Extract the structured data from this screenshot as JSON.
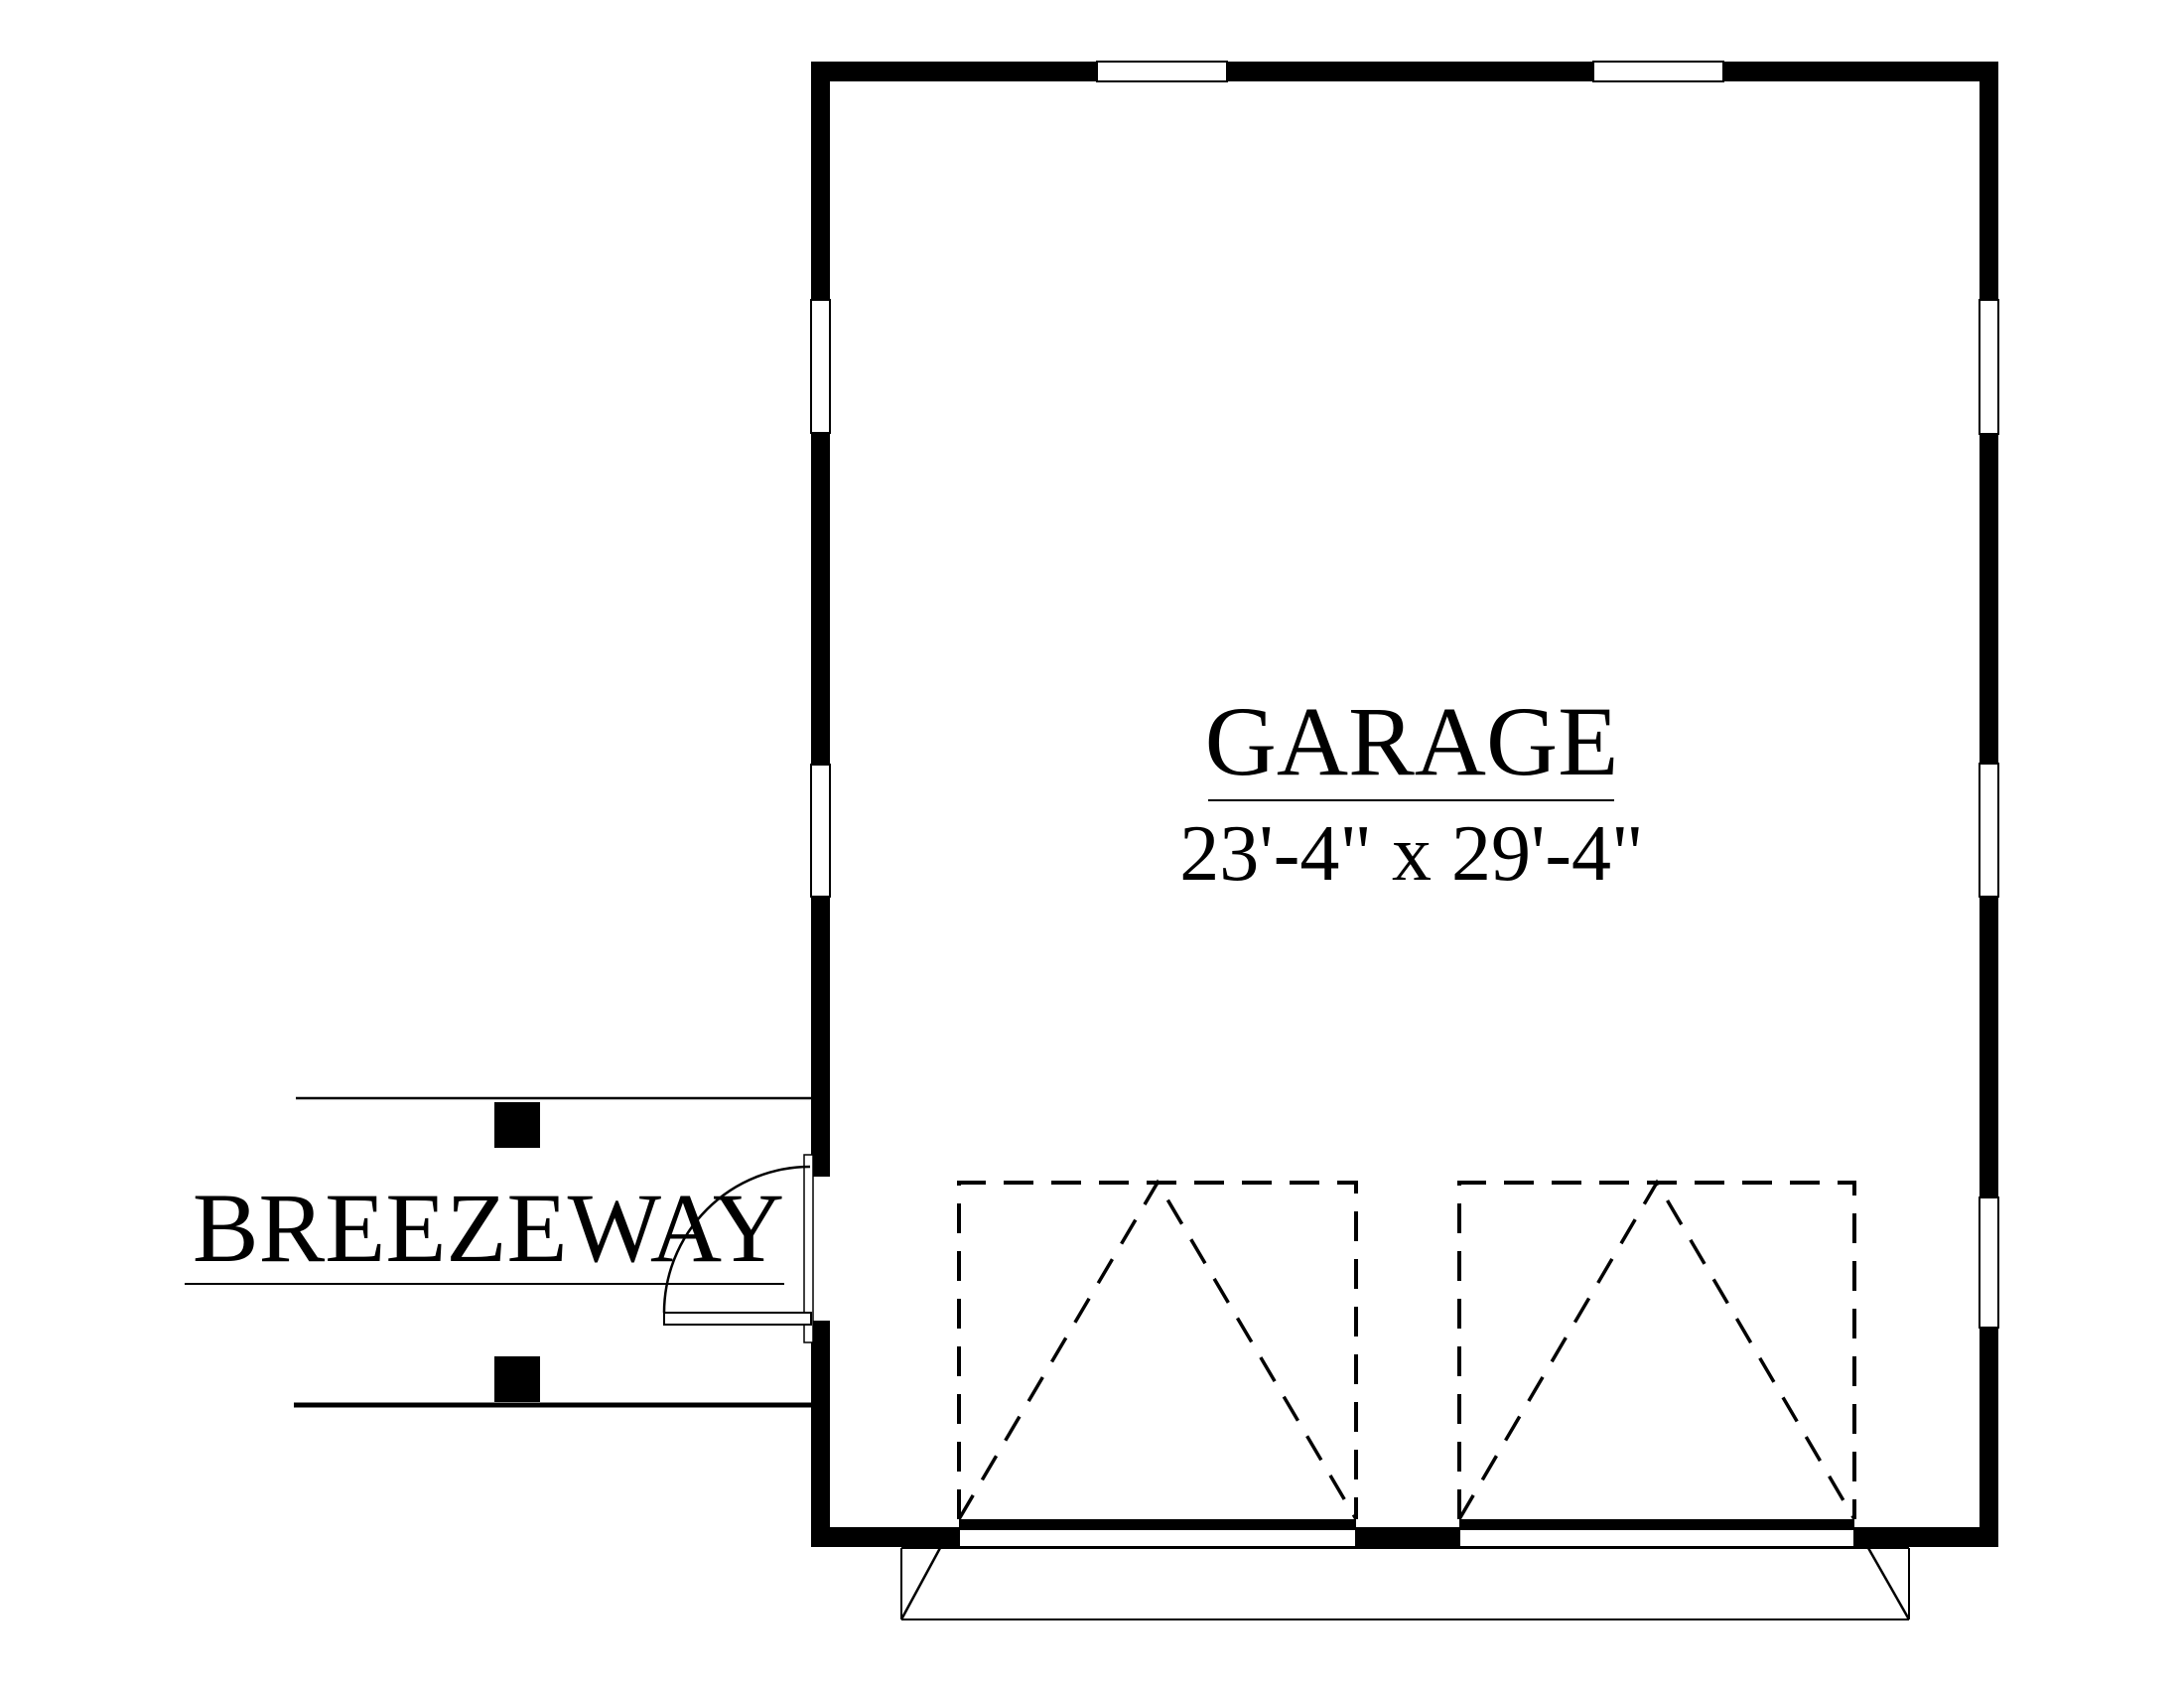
{
  "drawing_title": "Garage floor plan",
  "colors": {
    "ink": "#000000",
    "paper": "#ffffff"
  },
  "rooms": {
    "garage": {
      "label": "GARAGE",
      "dimensions": "23'-4\" x 29'-4\""
    },
    "breezeway": {
      "label": "BREEZEWAY"
    }
  },
  "features": {
    "garage_door_count": 2,
    "entry_door_count": 1,
    "window_count_top_wall": 2,
    "window_count_left_wall": 2,
    "window_count_right_wall": 3,
    "breezeway_post_count": 2
  }
}
